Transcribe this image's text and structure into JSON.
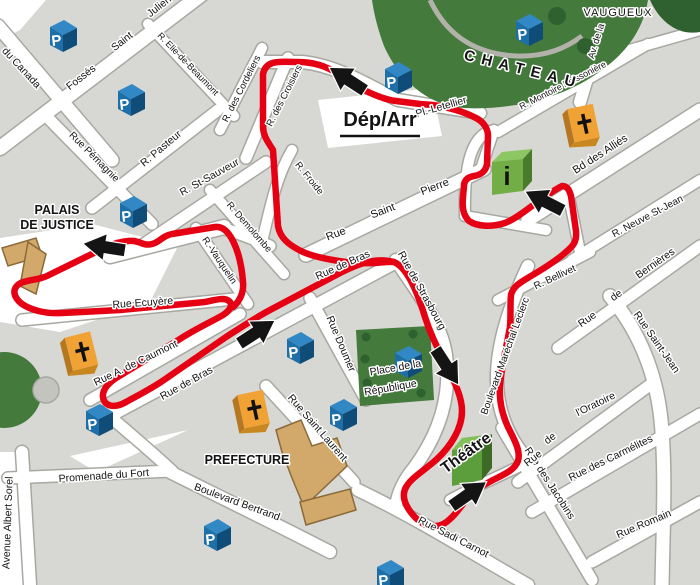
{
  "map": {
    "title": "tourist-train-route-city-map",
    "colors": {
      "block": "#d7d7d3",
      "street": "#ffffff",
      "casing": "#a8a8a2",
      "route": "#e60013",
      "green": "#447a3c",
      "green_dark": "#2e6030",
      "tan": "#d2a96b",
      "tan_edge": "#8a6a39",
      "blue_front": "#1e6ea8",
      "blue_top": "#3188c4",
      "blue_side": "#0f4c78",
      "orange": "#f0a234",
      "orange_side": "#b57722",
      "orange_bottom": "#c9871f",
      "info_front": "#72ad45",
      "info_top": "#8cc763",
      "info_side": "#4a7b2c",
      "theatre_front": "#5c9e3c",
      "theatre_top": "#83c05a",
      "theatre_side": "#3c6b26",
      "label": "#141414",
      "arrow": "#141414",
      "wall": "#b2b2aa",
      "park_circle_gray": "#c4c4bf"
    },
    "start_label": "Dép/Arr",
    "white_areas": [
      {
        "n": "plaza-dep-arr",
        "pts": "318,100 432,88 442,136 328,148"
      },
      {
        "n": "plaza-palais",
        "pts": "0,238 92,224 178,246 150,302 60,332 0,322"
      },
      {
        "n": "corner-top-left",
        "pts": "0,0 46,0 20,30 0,40"
      },
      {
        "n": "strip-left-bottom",
        "pts": "0,452 20,452 26,585 0,585"
      },
      {
        "n": "wedge-fort",
        "pts": "70,456 188,430 96,472"
      }
    ],
    "streets": [
      {
        "n": "fosses-saint-julien",
        "d": "M0,148 L202,-6",
        "w": 14
      },
      {
        "n": "avenue-du-canada",
        "d": "M-2,26 L112,160",
        "w": 13
      },
      {
        "n": "r-elie-de-beaumont",
        "d": "M148,24 L234,116",
        "w": 10
      },
      {
        "n": "rue-pemagnie",
        "d": "M50,120 L152,224",
        "w": 11
      },
      {
        "n": "r-pasteur",
        "d": "M92,208 L218,110",
        "w": 11
      },
      {
        "n": "r-st-sauveur",
        "d": "M138,248 L266,162",
        "w": 11
      },
      {
        "n": "place-st-sauveur",
        "d": "M110,256 L224,227",
        "w": 14
      },
      {
        "n": "link-sauveur-froide",
        "d": "M222,228 C245,235 258,241 270,246",
        "w": 11
      },
      {
        "n": "r-des-cordeliers",
        "d": "M220,130 L262,48",
        "w": 10
      },
      {
        "n": "r-des-croisiers",
        "d": "M246,158 L288,58",
        "w": 11
      },
      {
        "n": "top-street",
        "d": "M262,62 L302,62 C340,66 372,88 398,100 L480,113",
        "w": 12
      },
      {
        "n": "r-froide",
        "d": "M262,242 C272,198 278,174 292,150",
        "w": 10
      },
      {
        "n": "r-demolombe",
        "d": "M210,190 L284,274",
        "w": 10
      },
      {
        "n": "r-vauquelin",
        "d": "M196,228 L248,304",
        "w": 10
      },
      {
        "n": "rue-ecuyere",
        "d": "M22,320 L234,299",
        "w": 11
      },
      {
        "n": "rue-a-de-caumont",
        "d": "M90,400 L240,314",
        "w": 11
      },
      {
        "n": "rue-de-bras",
        "d": "M102,420 L400,260",
        "w": 12
      },
      {
        "n": "rue-saint-pierre",
        "d": "M306,255 L484,169",
        "w": 13
      },
      {
        "n": "link-stpierre-letellier",
        "d": "M480,172 L494,130",
        "w": 10
      },
      {
        "n": "info-block-west",
        "d": "M489,131 C470,140 464,168 465,216",
        "w": 10
      },
      {
        "n": "info-block-south",
        "d": "M465,216 L546,230",
        "w": 10
      },
      {
        "n": "bd-des-allies",
        "d": "M528,220 L700,110",
        "w": 13
      },
      {
        "n": "r-montoire-poissoniere",
        "d": "M498,132 L648,44",
        "w": 10
      },
      {
        "n": "av-de-la",
        "d": "M612,-5 L580,102",
        "w": 12
      },
      {
        "n": "vaugueux-street",
        "d": "M580,64 L700,30",
        "w": 10
      },
      {
        "n": "r-neuve-st-jean",
        "d": "M572,260 L700,180",
        "w": 10
      },
      {
        "n": "r-bellivet",
        "d": "M498,300 L590,252",
        "w": 10
      },
      {
        "n": "link-bellivet-allies",
        "d": "M580,252 L568,192",
        "w": 10
      },
      {
        "n": "rue-de-bernieres",
        "d": "M558,348 L700,246",
        "w": 11
      },
      {
        "n": "rue-saint-jean",
        "d": "M610,296 C638,330 656,372 661,420 C666,470 663,530 662,585",
        "w": 13
      },
      {
        "n": "bd-marechal-leclerc",
        "d": "M528,266 C512,300 498,340 497,374 C496,406 506,432 522,453 L532,463",
        "w": 12
      },
      {
        "n": "rue-de-strasbourg",
        "d": "M396,260 C415,290 441,320 446,355 C451,392 442,430 414,468 C404,480 398,492 396,506",
        "w": 12
      },
      {
        "n": "rue-des-jacobins",
        "d": "M502,428 L592,580",
        "w": 11
      },
      {
        "n": "rue-de-l-oratoire",
        "d": "M518,482 L654,382",
        "w": 11
      },
      {
        "n": "rue-des-carmelites",
        "d": "M532,512 L700,414",
        "w": 11
      },
      {
        "n": "rue-romain",
        "d": "M592,562 L700,502",
        "w": 11
      },
      {
        "n": "rue-sadi-carnot",
        "d": "M358,490 C420,520 472,553 528,585",
        "w": 12
      },
      {
        "n": "theatre-south-street",
        "d": "M450,500 C472,488 498,477 528,462",
        "w": 10
      },
      {
        "n": "rue-saint-laurent",
        "d": "M266,386 L354,482",
        "w": 11
      },
      {
        "n": "boulevard-bertrand",
        "d": "M170,472 C222,498 272,522 330,552",
        "w": 12
      },
      {
        "n": "link-fort-bras",
        "d": "M172,471 C150,450 125,430 105,412",
        "w": 11
      },
      {
        "n": "promenade-du-fort",
        "d": "M8,478 L172,471",
        "w": 11
      },
      {
        "n": "avenue-albert-sorel",
        "d": "M22,452 L30,585",
        "w": 12
      },
      {
        "n": "rue-doumer",
        "d": "M310,298 L366,400",
        "w": 11
      }
    ],
    "chateau": {
      "body": "M372,0 L648,0 C642,38 616,64 580,84 C544,103 500,110 464,108 C430,106 400,82 384,46 C378,30 374,14 372,0 Z",
      "corner_blob": "M650,0 L700,0 L700,32 C678,36 660,22 650,0 Z",
      "wall": "M430,0 C448,38 478,54 516,56 C546,57 566,48 582,36",
      "trees": [
        {
          "x": 557,
          "y": 16,
          "r": 9
        },
        {
          "x": 585,
          "y": 46,
          "r": 8
        }
      ]
    },
    "place_republique": {
      "pts": "356,330 430,326 434,400 360,406",
      "trees": [
        {
          "x": 366,
          "y": 337,
          "r": 4.5
        },
        {
          "x": 365,
          "y": 359,
          "r": 4.5
        },
        {
          "x": 367,
          "y": 383,
          "r": 4.5
        },
        {
          "x": 413,
          "y": 334,
          "r": 4.5
        },
        {
          "x": 421,
          "y": 393,
          "r": 4.5
        }
      ]
    },
    "park": {
      "circle": {
        "x": 4,
        "y": 390,
        "r": 38
      },
      "gray_circle": {
        "x": 46,
        "y": 390,
        "r": 13
      }
    },
    "buildings": [
      {
        "n": "palais-de-justice-building",
        "pts": "2,248 36,238 42,256 8,266"
      },
      {
        "n": "palais-de-justice-building",
        "pts": "28,242 46,254 36,294 20,286"
      },
      {
        "n": "prefecture-building",
        "pts": "276,430 301,420 312,446 337,438 347,466 304,507 292,478 282,452"
      },
      {
        "n": "prefecture-annex-building",
        "pts": "300,502 350,489 356,510 306,525"
      }
    ],
    "route": {
      "main": "M420,104 L396,101 C375,98 352,84 338,74 C325,65 312,62 298,62 C281,62 266,59 263,74 L263,126 C263,136 268,142 273,150 L278,226 C280,238 289,245 301,251 C313,257 331,260 346,262 L363,263 C376,264 386,261 394,262 C408,268 418,294 425,317 C432,339 440,352 447,367 C455,383 462,397 462,411 C462,429 450,447 437,459 C424,471 410,478 405,489 C401,499 408,511 418,520 C428,529 441,528 450,519 C458,512 462,504 470,496 C478,488 487,483 497,478 C507,473 515,469 518,461 C521,451 514,439 508,427 C502,414 499,399 500,385 C502,364 507,344 510,327 C511,314 510,304 511,295 C513,286 521,282 531,276 C543,269 556,261 566,252 C573,246 577,242 576,231 L571,196 C569,189 567,186 562,186 C552,191 545,197 536,203 C525,211 515,219 505,223 C492,227 478,227 469,221 C463,215 462,207 463,197 L464,186 C464,180 468,177 474,176 C481,175 486,171 487,164 L488,136 C488,128 483,121 474,117 C462,111 446,107 433,105 Z",
      "west": "M394,262 C375,257 358,264 340,273 L270,310 C255,318 240,328 226,337 L161,382 C147,391 135,397 126,402 C114,409 104,406 103,397 C102,389 110,381 121,375 L180,339 C197,328 213,321 223,315 C231,310 233,304 229,301 C224,297 215,300 205,302 L120,310 L62,313 C45,314 31,310 22,304 C13,297 12,289 19,284 C27,279 39,281 51,274 L98,251 C112,244 123,240 134,241 C141,242 144,246 152,244 C160,242 162,236 172,234 L215,227 C223,226 229,233 233,241 C239,253 242,268 243,282 C244,292 240,301 233,307"
    },
    "arrows": [
      {
        "x": 347,
        "y": 79,
        "r": -147
      },
      {
        "x": 104,
        "y": 247,
        "r": 189
      },
      {
        "x": 257,
        "y": 332,
        "r": -33
      },
      {
        "x": 447,
        "y": 367,
        "r": 57
      },
      {
        "x": 469,
        "y": 494,
        "r": -35
      },
      {
        "x": 544,
        "y": 201,
        "r": 207
      }
    ],
    "parking_icons": [
      {
        "x": 63,
        "y": 36
      },
      {
        "x": 131,
        "y": 100
      },
      {
        "x": 398,
        "y": 78
      },
      {
        "x": 529,
        "y": 30
      },
      {
        "x": 133,
        "y": 212
      },
      {
        "x": 300,
        "y": 348
      },
      {
        "x": 343,
        "y": 415
      },
      {
        "x": 99,
        "y": 420
      },
      {
        "x": 217,
        "y": 535
      },
      {
        "x": 408,
        "y": 362
      },
      {
        "x": 390,
        "y": 576
      }
    ],
    "church_icons": [
      {
        "x": 584,
        "y": 125,
        "r": -12
      },
      {
        "x": 82,
        "y": 353,
        "r": -14
      },
      {
        "x": 254,
        "y": 411,
        "r": -12
      }
    ],
    "info_icon": {
      "x": 507,
      "y": 172
    },
    "theatre_building": {
      "x": 467,
      "y": 460
    },
    "street_labels": [
      {
        "t": "Fossés",
        "x": 83,
        "y": 80,
        "r": -38,
        "s": 10.5
      },
      {
        "t": "Saint",
        "x": 124,
        "y": 44,
        "r": -38,
        "s": 10.5
      },
      {
        "t": "Julien",
        "x": 161,
        "y": 9,
        "r": -38,
        "s": 10.5
      },
      {
        "t": "du Canada",
        "x": 19,
        "y": 70,
        "r": 47,
        "s": 10.5
      },
      {
        "t": "R. Elie-de-Beaumont",
        "x": 186,
        "y": 66,
        "r": 46,
        "s": 9
      },
      {
        "t": "Rue Pémagnie",
        "x": 92,
        "y": 159,
        "r": 45,
        "s": 10
      },
      {
        "t": "R. Pasteur",
        "x": 163,
        "y": 151,
        "r": -40,
        "s": 10.5
      },
      {
        "t": "R. St-Sauveur",
        "x": 211,
        "y": 180,
        "r": -29,
        "s": 10.5
      },
      {
        "t": "R. des Cordeliers",
        "x": 244,
        "y": 90,
        "r": -63,
        "s": 9.5
      },
      {
        "t": "R. des Croisiers",
        "x": 287,
        "y": 97,
        "r": -63,
        "s": 9.5
      },
      {
        "t": "R. Froide",
        "x": 307,
        "y": 180,
        "r": 51,
        "s": 9.5
      },
      {
        "t": "R. Demolombe",
        "x": 247,
        "y": 229,
        "r": 49,
        "s": 9.5
      },
      {
        "t": "R.-Vauquelin",
        "x": 217,
        "y": 262,
        "r": 56,
        "s": 9.5
      },
      {
        "t": "Rue Ecuyère",
        "x": 143,
        "y": 306,
        "r": -4,
        "s": 10.5
      },
      {
        "t": "Rue A. de Caumont",
        "x": 137,
        "y": 366,
        "r": -26,
        "s": 10.5
      },
      {
        "t": "Rue de Bras",
        "x": 188,
        "y": 386,
        "r": -29,
        "s": 10.5
      },
      {
        "t": "Rue de Bras",
        "x": 344,
        "y": 268,
        "r": -24,
        "s": 10.5
      },
      {
        "t": "Rue",
        "x": 337,
        "y": 237,
        "r": -21,
        "s": 11
      },
      {
        "t": "Saint",
        "x": 384,
        "y": 214,
        "r": -21,
        "s": 11
      },
      {
        "t": "Pierre",
        "x": 436,
        "y": 190,
        "r": -21,
        "s": 11
      },
      {
        "t": "Rue de Strasbourg",
        "x": 419,
        "y": 292,
        "r": 61,
        "s": 10.5
      },
      {
        "t": "Rue Doumer",
        "x": 338,
        "y": 345,
        "r": 67,
        "s": 10.5
      },
      {
        "t": "Rue Saint Laurent",
        "x": 315,
        "y": 430,
        "r": 49,
        "s": 10.5
      },
      {
        "t": "Boulevard Bertrand",
        "x": 236,
        "y": 505,
        "r": 20,
        "s": 10.5
      },
      {
        "t": "Promenade du Fort",
        "x": 104,
        "y": 479,
        "r": -4,
        "s": 10.5
      },
      {
        "t": "Avenue Albert Sorel",
        "x": 11,
        "y": 523,
        "r": -88,
        "s": 10.5
      },
      {
        "t": "Rue Sadi Carnot",
        "x": 452,
        "y": 540,
        "r": 27,
        "s": 10.5
      },
      {
        "t": "Rue des Jacobins",
        "x": 547,
        "y": 485,
        "r": 57,
        "s": 10.5
      },
      {
        "t": "Rue",
        "x": 535,
        "y": 461,
        "r": -38,
        "s": 10.5
      },
      {
        "t": "de",
        "x": 552,
        "y": 441,
        "r": -38,
        "s": 10.5
      },
      {
        "t": "l'Oratoire",
        "x": 597,
        "y": 407,
        "r": -26,
        "s": 10.5
      },
      {
        "t": "Rue des Carmélites",
        "x": 612,
        "y": 461,
        "r": -26,
        "s": 10.5
      },
      {
        "t": "Rue Romain",
        "x": 645,
        "y": 527,
        "r": -23,
        "s": 10.5
      },
      {
        "t": "Boulevard Maréchal Leclerc",
        "x": 508,
        "y": 357,
        "r": -70,
        "s": 10
      },
      {
        "t": "R. Bellivet",
        "x": 556,
        "y": 280,
        "r": -25,
        "s": 10
      },
      {
        "t": "R. Neuve St-Jean",
        "x": 649,
        "y": 219,
        "r": -28,
        "s": 10
      },
      {
        "t": "Rue",
        "x": 589,
        "y": 322,
        "r": -35,
        "s": 10.5
      },
      {
        "t": "de",
        "x": 618,
        "y": 298,
        "r": -35,
        "s": 10.5
      },
      {
        "t": "Bernières",
        "x": 657,
        "y": 266,
        "r": -35,
        "s": 10.5
      },
      {
        "t": "Rue Saint-Jean",
        "x": 654,
        "y": 344,
        "r": 55,
        "s": 10.5
      },
      {
        "t": "Bd des Alliés",
        "x": 602,
        "y": 157,
        "r": -33,
        "s": 11
      },
      {
        "t": "R. Montoire Poissonière",
        "x": 564,
        "y": 88,
        "r": -27,
        "s": 9
      },
      {
        "t": "Av. de la",
        "x": 599,
        "y": 42,
        "r": -73,
        "s": 9.5
      },
      {
        "t": "Pl.-Letellier",
        "x": 442,
        "y": 110,
        "r": -16,
        "s": 10.5
      }
    ],
    "landmark_labels": [
      {
        "t": "VAUGUEUX",
        "x": 618,
        "y": 16,
        "r": 0,
        "s": 11,
        "ls": 1
      },
      {
        "t": "CHATEAU",
        "x": 522,
        "y": 74,
        "r": 14,
        "s": 15,
        "b": true,
        "ls": 7
      },
      {
        "t": "PALAIS",
        "x": 57,
        "y": 214,
        "r": 0,
        "s": 12.5,
        "b": true
      },
      {
        "t": "DE JUSTICE",
        "x": 57,
        "y": 229,
        "r": 0,
        "s": 12.5,
        "b": true
      },
      {
        "t": "PREFECTURE",
        "x": 247,
        "y": 464,
        "r": 0,
        "s": 12.5,
        "b": true
      },
      {
        "t": "Dép/Arr",
        "x": 380,
        "y": 126,
        "r": 0,
        "s": 20,
        "b": true,
        "u": true
      },
      {
        "t": "Théâtre",
        "x": 469,
        "y": 457,
        "r": -36,
        "s": 16,
        "b": true
      },
      {
        "t": "Place de la",
        "x": 396,
        "y": 371,
        "r": -10,
        "s": 10.5
      },
      {
        "t": "République",
        "x": 391,
        "y": 391,
        "r": -10,
        "s": 10.5
      }
    ]
  }
}
